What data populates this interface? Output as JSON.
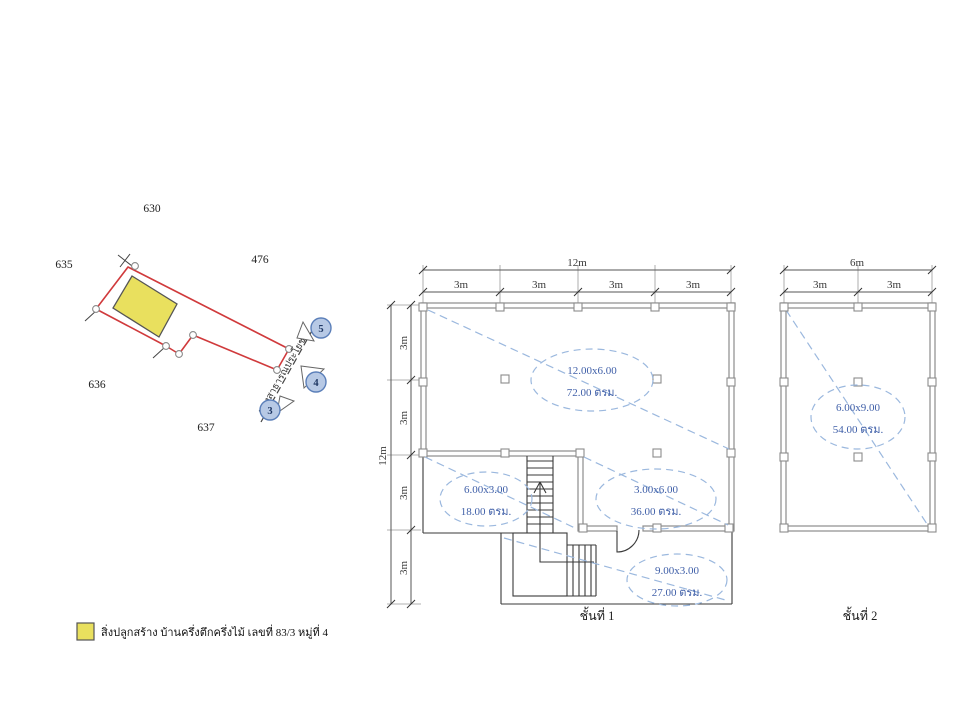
{
  "site_plan": {
    "parcels": [
      "630",
      "635",
      "476",
      "636",
      "637"
    ],
    "road_label": "ทางสาธารณประโยชน์",
    "markers": [
      "3",
      "4",
      "5"
    ],
    "building_fill": "#e9e05e",
    "boundary_color": "#d03a3c"
  },
  "floor1": {
    "title": "ชั้นที่ 1",
    "width_total": "12m",
    "width_segments": [
      "3m",
      "3m",
      "3m",
      "3m"
    ],
    "height_total": "12m",
    "height_segments": [
      "3m",
      "3m",
      "3m",
      "3m"
    ],
    "rooms": [
      {
        "size": "12.00x6.00",
        "area": "72.00 ตรม."
      },
      {
        "size": "6.00x3.00",
        "area": "18.00 ตรม."
      },
      {
        "size": "3.00x6.00",
        "area": "36.00 ตรม."
      },
      {
        "size": "9.00x3.00",
        "area": "27.00 ตรม."
      }
    ]
  },
  "floor2": {
    "title": "ชั้นที่ 2",
    "width_total": "6m",
    "width_segments": [
      "3m",
      "3m"
    ],
    "rooms": [
      {
        "size": "6.00x9.00",
        "area": "54.00 ตรม."
      }
    ]
  },
  "legend": {
    "label": "สิ่งปลูกสร้าง บ้านครึ่งตึกครึ่งไม้ เลขที่ 83/3 หมู่ที่ 4",
    "swatch_color": "#e9e05e"
  },
  "colors": {
    "boundary_red": "#d03a3c",
    "room_text_blue": "#3f5fa8",
    "dashed_blue": "#9bb8de",
    "wall_gray": "#8c8c8c"
  }
}
